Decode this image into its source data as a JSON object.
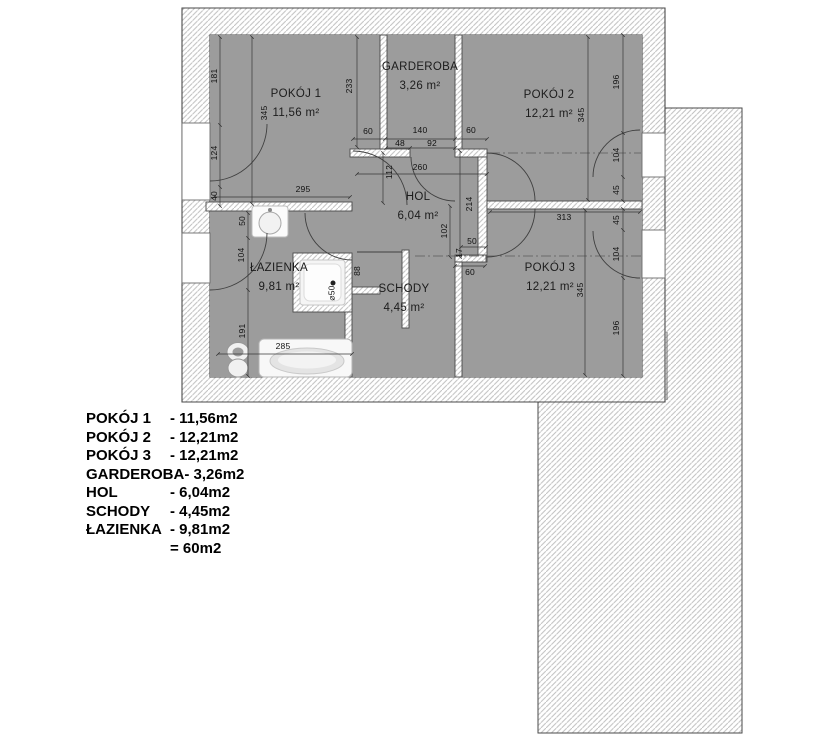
{
  "plan": {
    "rooms": [
      {
        "label": "POKÓJ 1",
        "area": "11,56 m²",
        "x": 296,
        "y": 104
      },
      {
        "label": "GARDEROBA",
        "area": "3,26 m²",
        "x": 420,
        "y": 77
      },
      {
        "label": "POKÓJ 2",
        "area": "12,21 m²",
        "x": 549,
        "y": 105
      },
      {
        "label": "HOL",
        "area": "6,04 m²",
        "x": 418,
        "y": 207
      },
      {
        "label": "ŁAZIENKA",
        "area": "9,81 m²",
        "x": 279,
        "y": 278
      },
      {
        "label": "SCHODY",
        "area": "4,45 m²",
        "x": 404,
        "y": 299
      },
      {
        "label": "POKÓJ 3",
        "area": "12,21 m²",
        "x": 550,
        "y": 278
      }
    ],
    "dims": [
      {
        "t": "181",
        "x": 214,
        "y": 76,
        "r": 1
      },
      {
        "t": "124",
        "x": 214,
        "y": 153,
        "r": 1
      },
      {
        "t": "40",
        "x": 214,
        "y": 196,
        "r": 1
      },
      {
        "t": "345",
        "x": 264,
        "y": 113,
        "r": 1
      },
      {
        "t": "295",
        "x": 303,
        "y": 189
      },
      {
        "t": "233",
        "x": 349,
        "y": 86,
        "r": 1
      },
      {
        "t": "60",
        "x": 368,
        "y": 131
      },
      {
        "t": "140",
        "x": 420,
        "y": 130
      },
      {
        "t": "60",
        "x": 471,
        "y": 130
      },
      {
        "t": "48",
        "x": 400,
        "y": 143
      },
      {
        "t": "92",
        "x": 432,
        "y": 143
      },
      {
        "t": "260",
        "x": 420,
        "y": 167
      },
      {
        "t": "112",
        "x": 389,
        "y": 172,
        "r": 1
      },
      {
        "t": "214",
        "x": 469,
        "y": 204,
        "r": 1
      },
      {
        "t": "102",
        "x": 444,
        "y": 231,
        "r": 1
      },
      {
        "t": "50",
        "x": 472,
        "y": 241
      },
      {
        "t": "17",
        "x": 459,
        "y": 253,
        "r": 1
      },
      {
        "t": "60",
        "x": 470,
        "y": 272
      },
      {
        "t": "88",
        "x": 357,
        "y": 271,
        "r": 1
      },
      {
        "t": "50",
        "x": 242,
        "y": 221,
        "r": 1
      },
      {
        "t": "104",
        "x": 241,
        "y": 255,
        "r": 1
      },
      {
        "t": "191",
        "x": 242,
        "y": 331,
        "r": 1
      },
      {
        "t": "285",
        "x": 283,
        "y": 346
      },
      {
        "t": "⌀50",
        "x": 332,
        "y": 293,
        "r": 1
      },
      {
        "t": "345",
        "x": 581,
        "y": 115,
        "r": 1
      },
      {
        "t": "196",
        "x": 616,
        "y": 82,
        "r": 1
      },
      {
        "t": "104",
        "x": 616,
        "y": 155,
        "r": 1
      },
      {
        "t": "45",
        "x": 616,
        "y": 190,
        "r": 1
      },
      {
        "t": "313",
        "x": 564,
        "y": 217
      },
      {
        "t": "345",
        "x": 580,
        "y": 290,
        "r": 1
      },
      {
        "t": "45",
        "x": 616,
        "y": 220,
        "r": 1
      },
      {
        "t": "104",
        "x": 616,
        "y": 254,
        "r": 1
      },
      {
        "t": "196",
        "x": 616,
        "y": 328,
        "r": 1
      }
    ],
    "colors": {
      "floor": "#9c9c9c",
      "hatch_line": "#bfbfbf",
      "outline": "#4a4a4a"
    }
  },
  "legend": {
    "items": [
      {
        "n": "POKÓJ 1",
        "v": "- 11,56m2"
      },
      {
        "n": "POKÓJ 2",
        "v": "- 12,21m2"
      },
      {
        "n": "POKÓJ 3",
        "v": "- 12,21m2"
      },
      {
        "n": "GARDEROBA",
        "v": "- 3,26m2"
      },
      {
        "n": "HOL",
        "v": "- 6,04m2"
      },
      {
        "n": "SCHODY",
        "v": "- 4,45m2"
      },
      {
        "n": "ŁAZIENKA",
        "v": "- 9,81m2"
      },
      {
        "n": "",
        "v": "= 60m2"
      }
    ]
  }
}
